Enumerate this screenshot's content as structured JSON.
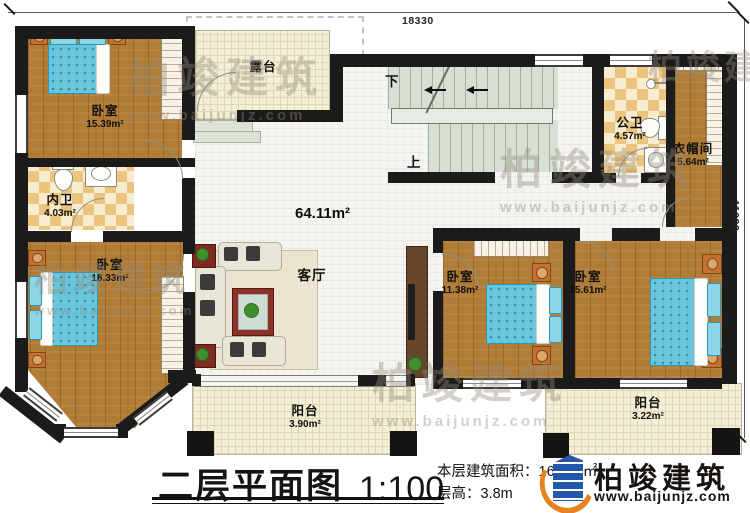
{
  "plan": {
    "dims": {
      "top": "18330",
      "right": "11020"
    },
    "rooms": {
      "bedroom_tl": {
        "name": "卧室",
        "area": "15.39m²"
      },
      "inner_bath": {
        "name": "内卫",
        "area": "4.03m²"
      },
      "bedroom_bl": {
        "name": "卧室",
        "area": "18.33m²"
      },
      "terrace": {
        "name": "露台"
      },
      "living": {
        "name": "客厅",
        "area": "64.11m²"
      },
      "public_bath": {
        "name": "公卫",
        "area": "4.57m²"
      },
      "cloakroom": {
        "name": "衣帽间",
        "area": "5.64m²"
      },
      "bedroom_bc": {
        "name": "卧室",
        "area": "11.38m²"
      },
      "bedroom_br": {
        "name": "卧室",
        "area": "15.61m²"
      },
      "balcony_l": {
        "name": "阳台",
        "area": "3.90m²"
      },
      "balcony_r": {
        "name": "阳台",
        "area": "3.22m²"
      }
    },
    "stairs": {
      "up": "上",
      "down": "下"
    }
  },
  "footer": {
    "title": "二层平面图",
    "scale": "1:100",
    "area_line": "本层建筑面积：169.12㎡",
    "height_line": "层高：3.8m"
  },
  "brand": {
    "name": "柏竣建筑",
    "url": "www.baijunjz.com"
  },
  "watermark": {
    "text": "柏竣建筑",
    "url": "www.baijunjz.com"
  },
  "colors": {
    "wall": "#1b1b1b",
    "wood": "#b07c36",
    "tile_cream": "#f3eed6",
    "stair": "#d8dfd5",
    "bed_blue": "#67c6dc",
    "brand_blue": "#2456ac",
    "brand_orange": "#e8821e"
  }
}
